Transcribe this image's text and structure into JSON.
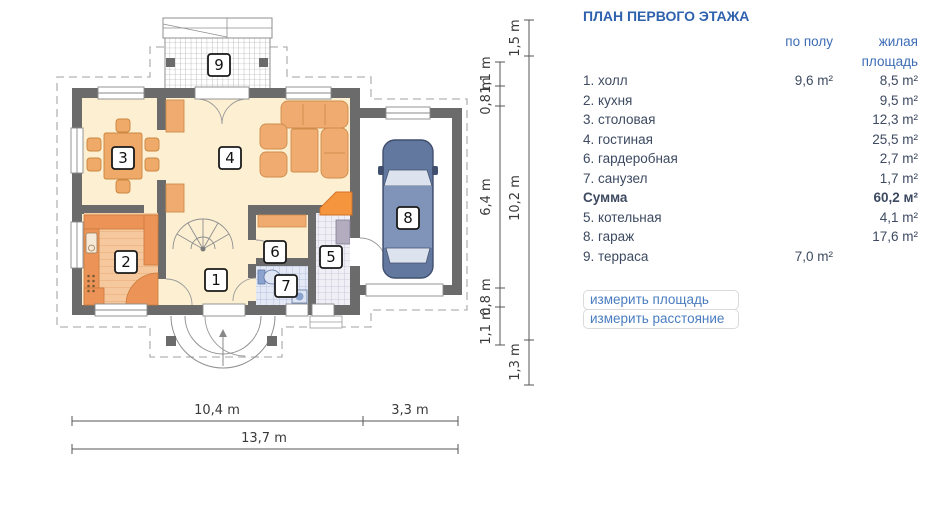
{
  "panel": {
    "title": "ПЛАН ПЕРВОГО ЭТАЖА",
    "columns": {
      "floor": "по полу",
      "living": "жилая\nплощадь"
    },
    "rows": [
      {
        "name": "1. холл",
        "floor": "9,6 m²",
        "living": "8,5 m²"
      },
      {
        "name": "2. кухня",
        "floor": "",
        "living": "9,5 m²"
      },
      {
        "name": "3. столовая",
        "floor": "",
        "living": "12,3 m²"
      },
      {
        "name": "4. гостиная",
        "floor": "",
        "living": "25,5 m²"
      },
      {
        "name": "6. гардеробная",
        "floor": "",
        "living": "2,7 m²"
      },
      {
        "name": "7. санузел",
        "floor": "",
        "living": "1,7 m²"
      },
      {
        "name": "Сумма",
        "floor": "",
        "living": "60,2 м²"
      },
      {
        "name": "5. котельная",
        "floor": "",
        "living": "4,1 m²"
      },
      {
        "name": "8. гараж",
        "floor": "",
        "living": "17,6 m²"
      },
      {
        "name": "9. терраса",
        "floor": "7,0 m²",
        "living": ""
      }
    ],
    "links": {
      "measure_area": "измерить площадь",
      "measure_distance": "измерить расстояние"
    }
  },
  "plan": {
    "badges": [
      "1",
      "2",
      "3",
      "4",
      "5",
      "6",
      "7",
      "8",
      "9"
    ],
    "dims": {
      "inner": [
        "1,1 m",
        "0,8 m",
        "6,4 m",
        "0,8 m",
        "1,1 m"
      ],
      "outer": [
        "1,5 m",
        "10,2 m",
        "1,3 m"
      ],
      "bottom": [
        "10,4 m",
        "3,3 m",
        "13,7 m"
      ]
    },
    "colors": {
      "wall": "#6b6b6b",
      "floor": "#fcefd2",
      "furniture": "#f0ab70",
      "counter": "#ec9457",
      "fireplace": "#f5953d",
      "car_body": "#63789f",
      "tile_blue": "#e4e9f5",
      "accent_blue": "#3e6db6"
    }
  }
}
